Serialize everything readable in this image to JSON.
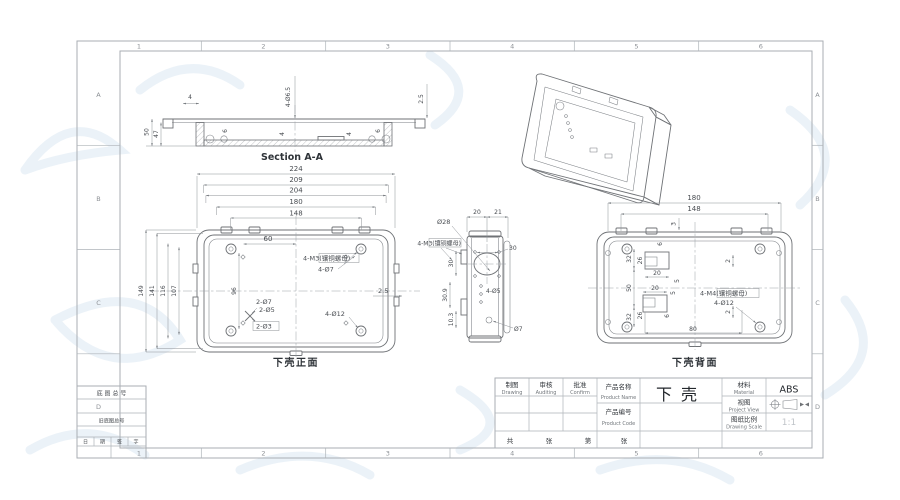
{
  "sheet": {
    "cols": [
      "1",
      "2",
      "3",
      "4",
      "5",
      "6"
    ],
    "rows": [
      "A",
      "B",
      "C",
      "D"
    ]
  },
  "section": {
    "caption": "Section A-A",
    "d4": "4",
    "dhole": "4-Ø6.5",
    "d25": "2.5",
    "d50": "50",
    "d47": "47",
    "d6a": "6",
    "d6b": "6",
    "d4a": "4",
    "d4b": "4"
  },
  "front": {
    "caption": "下壳正面",
    "chain": [
      "224",
      "209",
      "204",
      "180",
      "148"
    ],
    "d60": "60",
    "left": [
      "149",
      "141",
      "116",
      "107"
    ],
    "d96": "96",
    "d25": "2.5",
    "m3": "4-M3(镶铜螺母)",
    "d7": "4-Ø7",
    "h27": "2-Ø7",
    "h25": "2-Ø5",
    "h23": "2-Ø3",
    "h412": "4-Ø12"
  },
  "side": {
    "d20": "20",
    "d21": "21",
    "d28": "Ø28",
    "d30r": "30",
    "d30l": "30",
    "d309": "30.9",
    "d103": "10.3",
    "m3": "4-M3(镶铜螺母)",
    "d45": "4-Ø5",
    "d7": "Ø7"
  },
  "back": {
    "caption": "下壳背面",
    "d180": "180",
    "d148": "148",
    "d3": "3",
    "d32t": "32",
    "d26t": "26",
    "d50": "50",
    "d26b": "26",
    "d32b": "32",
    "d20t": "20",
    "d20b": "20",
    "d5t": "5",
    "d5b": "5",
    "d6t": "6",
    "d6b": "6",
    "d2t": "2",
    "d2b": "2",
    "d80": "80",
    "m4": "4-M4(镶铜螺母)",
    "d412": "4-Ø12"
  },
  "title_block": {
    "drafter_cn": "制图",
    "drafter_en": "Drawing",
    "auditor_cn": "审核",
    "auditor_en": "Auditing",
    "approver_cn": "批准",
    "approver_en": "Confirm",
    "product_name_cn": "产品名称",
    "product_name_en": "Product Name",
    "product_code_cn": "产品编号",
    "product_code_en": "Product Code",
    "product_name_value": "下壳",
    "material_cn": "材料",
    "material_en": "Material",
    "material_value": "ABS",
    "view_cn": "视图",
    "view_en": "Project View",
    "scale_cn": "图纸比例",
    "scale_en": "Drawing Scale",
    "scale_value": "1:1",
    "sheets": [
      "共",
      "张",
      "第",
      "张"
    ]
  },
  "aux": {
    "r1": "底 图 总 号",
    "r3": "旧底图总号",
    "cells": [
      "日",
      "期",
      "签",
      "字"
    ]
  }
}
